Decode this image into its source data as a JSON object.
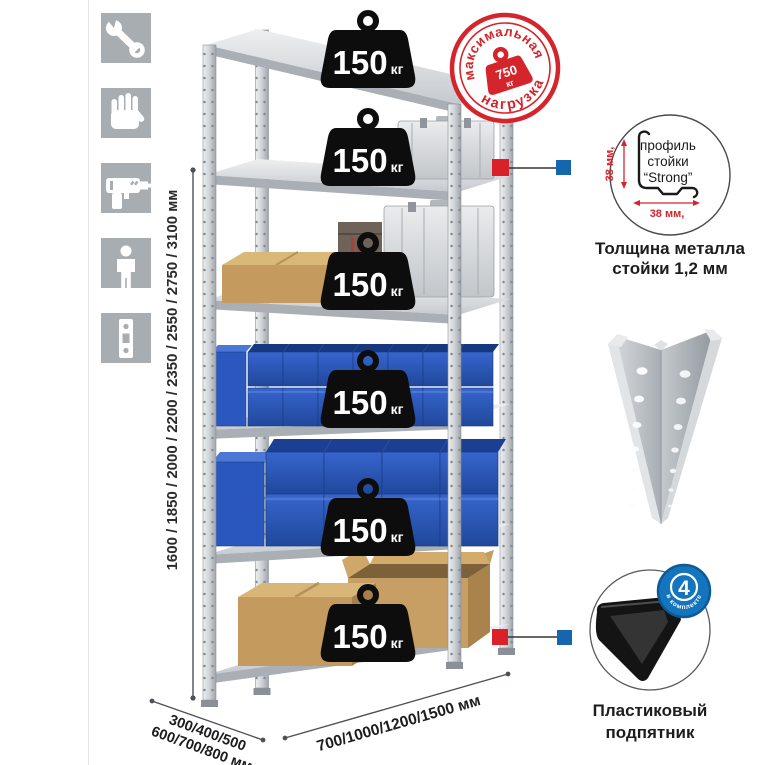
{
  "sidebar": {
    "icons": [
      {
        "name": "wrench-icon"
      },
      {
        "name": "gloves-icon"
      },
      {
        "name": "drill-icon"
      },
      {
        "name": "person-icon"
      },
      {
        "name": "perforated-strip-icon"
      }
    ]
  },
  "dimensions": {
    "height": "1600 / 1850 / 2000 / 2200 / 2350 / 2550 / 2750 / 3100 мм",
    "depth_line1": "300/400/500",
    "depth_line2": "600/700/800 мм",
    "width": "700/1000/1200/1500 мм"
  },
  "shelf_badges": [
    {
      "value": "150",
      "unit": "кг"
    },
    {
      "value": "150",
      "unit": "кг"
    },
    {
      "value": "150",
      "unit": "кг"
    },
    {
      "value": "150",
      "unit": "кг"
    },
    {
      "value": "150",
      "unit": "кг"
    },
    {
      "value": "150",
      "unit": "кг"
    }
  ],
  "max_load_stamp": {
    "arc_top": "максимальная",
    "arc_bottom": "нагрузка",
    "value": "750",
    "unit": "кг"
  },
  "profile_detail": {
    "line1": "профиль",
    "line2": "стойки",
    "line3": "“Strong”",
    "dim_vertical": "38 мм,",
    "dim_horizontal": "38 мм,",
    "caption1": "Толщина металла",
    "caption2": "стойки 1,2 мм"
  },
  "foot_detail": {
    "count": "4",
    "count_caption": "в комплекте",
    "caption1": "Пластиковый",
    "caption2": "подпятник"
  },
  "colors": {
    "accent_red": "#d4252c",
    "connector_red": "#da2128",
    "connector_blue": "#1566ad",
    "badge_black": "#0d0d0d",
    "bin_blue": "#2b59c0",
    "metal_gray": "#c9cdd1",
    "icon_bg": "#a8adb2"
  }
}
